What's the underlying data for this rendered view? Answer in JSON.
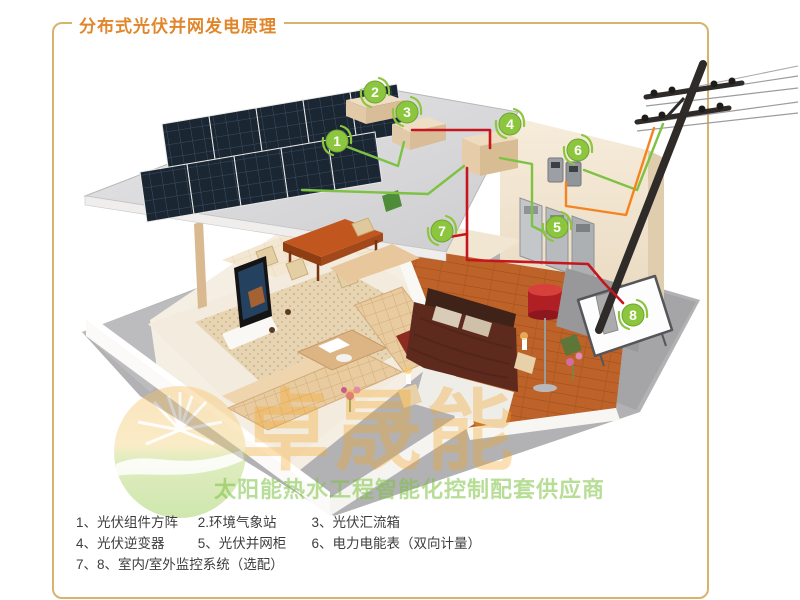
{
  "title": "分布式光伏并网发电原理",
  "colors": {
    "frame_border": "#d9b26e",
    "title_orange": "#e0862b",
    "marker_green": "#8cc63f",
    "wire_green": "#7dc242",
    "wire_red": "#c5161d",
    "wire_orange": "#f5831f"
  },
  "markers": [
    {
      "label": "1"
    },
    {
      "label": "2"
    },
    {
      "label": "3"
    },
    {
      "label": "4"
    },
    {
      "label": "5"
    },
    {
      "label": "6"
    },
    {
      "label": "7"
    },
    {
      "label": "8"
    }
  ],
  "legend": {
    "rows": [
      {
        "items": [
          "1、光伏组件方阵",
          "2.环境气象站",
          "3、光伏汇流箱"
        ]
      },
      {
        "items": [
          "4、光伏逆变器",
          "5、光伏并网柜",
          "6、电力电能表（双向计量）"
        ]
      },
      {
        "items": [
          "7、8、室内/室外监控系统（选配）"
        ]
      }
    ]
  },
  "watermark": {
    "brand": "卓晟能",
    "slogan": "太阳能热水工程智能化控制配套供应商"
  }
}
